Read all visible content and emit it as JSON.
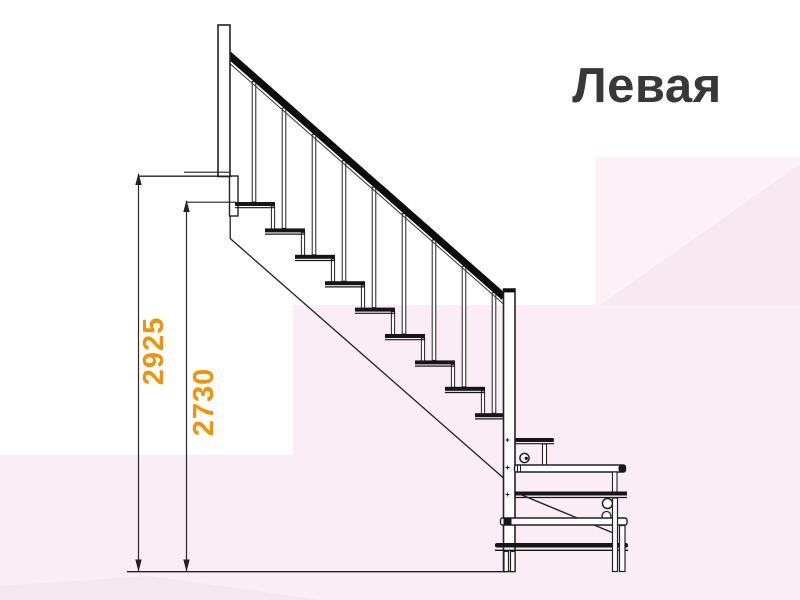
{
  "title": "Левая",
  "dimensions": {
    "floor_height": "2925",
    "top_step_height": "2730"
  },
  "colors": {
    "accent_orange": "#f39206",
    "title_gray": "#383838",
    "line_dark": "#222222"
  }
}
